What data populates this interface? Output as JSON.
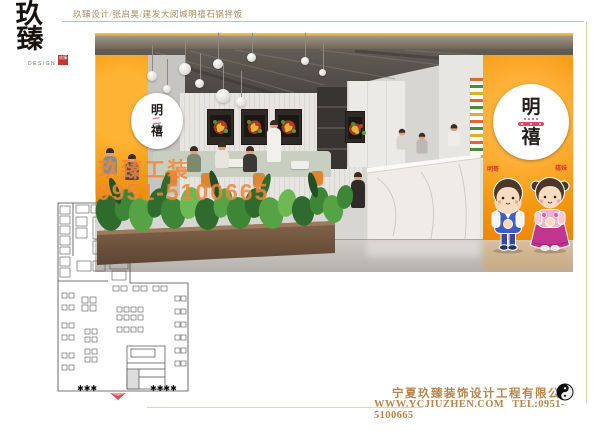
{
  "header": {
    "logo_chars": "玖臻",
    "logo_sub": "DESIGN",
    "logo_seal": "玖臻",
    "project_line": "玖臻设计/张启昊/建发大阅城明禧石锅拌饭"
  },
  "watermark": {
    "line1": "玖臻工装",
    "line2": "0951-5100665"
  },
  "render": {
    "left_sign": {
      "l1": "明",
      "l2": "二",
      "l3": "禧"
    },
    "right_sign": {
      "r1": "明",
      "r2": "禧"
    },
    "mascots": {
      "boy_label": "明哥",
      "girl_label": "禧妹"
    }
  },
  "footer": {
    "company": "宁夏玖臻装饰设计工程有限公司",
    "website": "WWW.YCJIUZHEN.COM",
    "tel": "TEL:0951-5100665"
  },
  "colors": {
    "accent_orange": "#F59A14",
    "gold": "#B8854C",
    "watermark_orange": "#F07E2E",
    "seal_red": "#BF3A2B",
    "entrance_red": "#D94F4F"
  }
}
